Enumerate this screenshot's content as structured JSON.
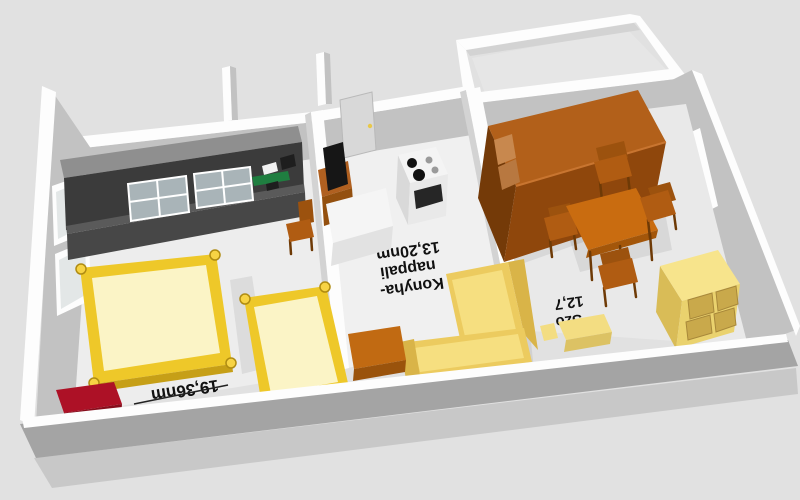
{
  "view": {
    "type": "3d-floor-plan-render",
    "orientation": "labels appear upside-down (camera faces plan from the north side)"
  },
  "rooms": [
    {
      "name": "bedroom-living-room",
      "label": "19,36nm"
    },
    {
      "name": "kitchen-living-room",
      "label_lines": [
        "Konyha-",
        "nappali",
        "13,20nm"
      ]
    },
    {
      "name": "room-szoba",
      "label_lines": [
        "Szo",
        "12,7"
      ]
    }
  ],
  "furniture": [
    {
      "name": "dark-wall-unit-with-glass-cabinets",
      "room": "bedroom-living-room"
    },
    {
      "name": "double-bed",
      "room": "bedroom-living-room"
    },
    {
      "name": "single-bed",
      "room": "bedroom-living-room"
    },
    {
      "name": "dark-red-chest",
      "room": "bedroom-living-room"
    },
    {
      "name": "wooden-chair",
      "room": "bedroom-living-room"
    },
    {
      "name": "tv-on-brown-cabinet",
      "room": "kitchen-living-room"
    },
    {
      "name": "white-kitchen-counter",
      "room": "kitchen-living-room"
    },
    {
      "name": "stove-with-burners",
      "room": "kitchen-living-room"
    },
    {
      "name": "interior-door",
      "room": "kitchen-living-room"
    },
    {
      "name": "yellow-corner-sofa",
      "room": "kitchen-living-room"
    },
    {
      "name": "orange-coffee-table",
      "room": "kitchen-living-room"
    },
    {
      "name": "brown-wardrobe",
      "room": "room-szoba"
    },
    {
      "name": "dining-table-with-four-chairs",
      "room": "room-szoba"
    },
    {
      "name": "yellow-dresser",
      "room": "room-szoba"
    },
    {
      "name": "yellow-bench",
      "room": "room-szoba"
    }
  ],
  "colors": {
    "bg": "#e1e1e1",
    "label": "#111111",
    "wall_white": "#fdfdfd",
    "wall_face": "#c2c2c2",
    "wall_face_light": "#d3d3d3",
    "front_cut": "#a4a4a4",
    "outer_face": "#c8c8c8",
    "floor_big": "#ededed",
    "floor_mid": "#f0f0f0",
    "floor_szoba": "#e9e9e9",
    "floor_terrace": "#e6e6e6",
    "door": "#d8d8d8",
    "window_pane": "#e3e7e7",
    "unit_top": "#8f8f8f",
    "unit_dark": "#3b3b3b",
    "unit_lower": "#474747",
    "unit_lip": "#5a5a5a",
    "glass": "#a9b4b8",
    "item_green": "#1f7e40",
    "item_white": "#f2f2f2",
    "item_dark": "#1e1e1e",
    "bed_frame": "#eec829",
    "bed_mattress": "#fbf4c6",
    "bed_shade": "#c69f17",
    "bed_post": "#f7d344",
    "chest_top": "#ad1126",
    "chest_front": "#870d1c",
    "chair_seat": "#b05c12",
    "chair_back": "#9c520e",
    "chair_leg": "#6e3a06",
    "tvcab_top": "#b06020",
    "tvcab_front": "#94500f",
    "tv_black": "#161616",
    "counter_top": "#f5f5f5",
    "counter_front": "#e2e2e2",
    "stove_top": "#f4f4f4",
    "stove_front": "#e9e9e9",
    "stove_side": "#d9d9d9",
    "oven": "#262626",
    "burner_black": "#111111",
    "burner_gray": "#9a9a9a",
    "sofa_light": "#f6df80",
    "sofa_mid": "#eccb5f",
    "sofa_dark": "#d9b448",
    "ctable_top": "#c16a12",
    "ctable_front": "#9a530c",
    "wardrobe_top": "#b2601a",
    "wardrobe_front": "#8f470c",
    "wardrobe_side": "#743a08",
    "shelf_tan": "#c8884e",
    "shelf_tan2": "#b87840",
    "dtable_top": "#c96c10",
    "dtable_edge": "#a3560a",
    "dresser_top": "#f7e48c",
    "dresser_front": "#ead26e",
    "dresser_side": "#d9bc57",
    "drawer": "#c9a94b",
    "bench_top": "#f3dd82",
    "bench_front": "#dcc264"
  }
}
